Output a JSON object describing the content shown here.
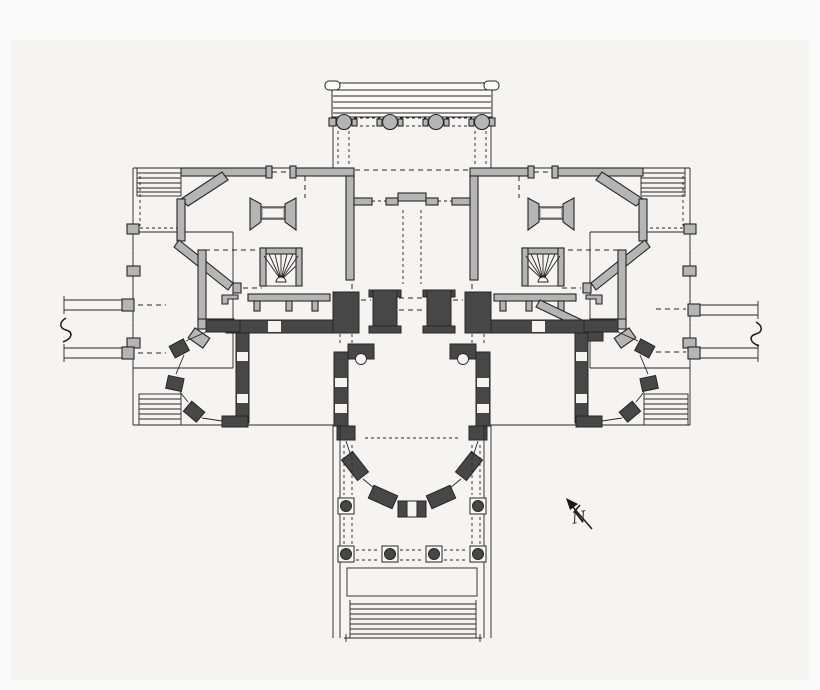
{
  "page": {
    "background_outer": "#fafafa",
    "background": "#f6f4f1",
    "kind": "hand-drawn architectural floor plan, cruciform villa, two levels overlaid"
  },
  "colors": {
    "background_outer": "#fafafa",
    "background": "#f6f4f1",
    "paper": "#fcfbf9",
    "wall_light": "#b5b5b5",
    "wall_dark": "#474747",
    "line": "#262626",
    "ink": "#1a1a1a"
  },
  "compass": {
    "label": "N",
    "direction": "up-left"
  },
  "drawing": {
    "features": [
      "north-portico-entablature",
      "north-portico-columns",
      "entrance-hall",
      "octagonal-room-northwest",
      "octagonal-room-northeast",
      "winder-stair-left",
      "winder-stair-right",
      "west-wing-room",
      "east-wing-room",
      "corner-steps-northwest",
      "corner-steps-northeast",
      "corner-steps-southwest",
      "corner-steps-southeast",
      "lower-level-corridor-walls",
      "lower-octagonal-room-southwest",
      "lower-octagonal-room-southeast",
      "south-bow-salon",
      "south-portico-columns",
      "south-steps",
      "terrace-wall-west",
      "terrace-wall-east",
      "wall-break-marks",
      "north-arrow"
    ]
  }
}
